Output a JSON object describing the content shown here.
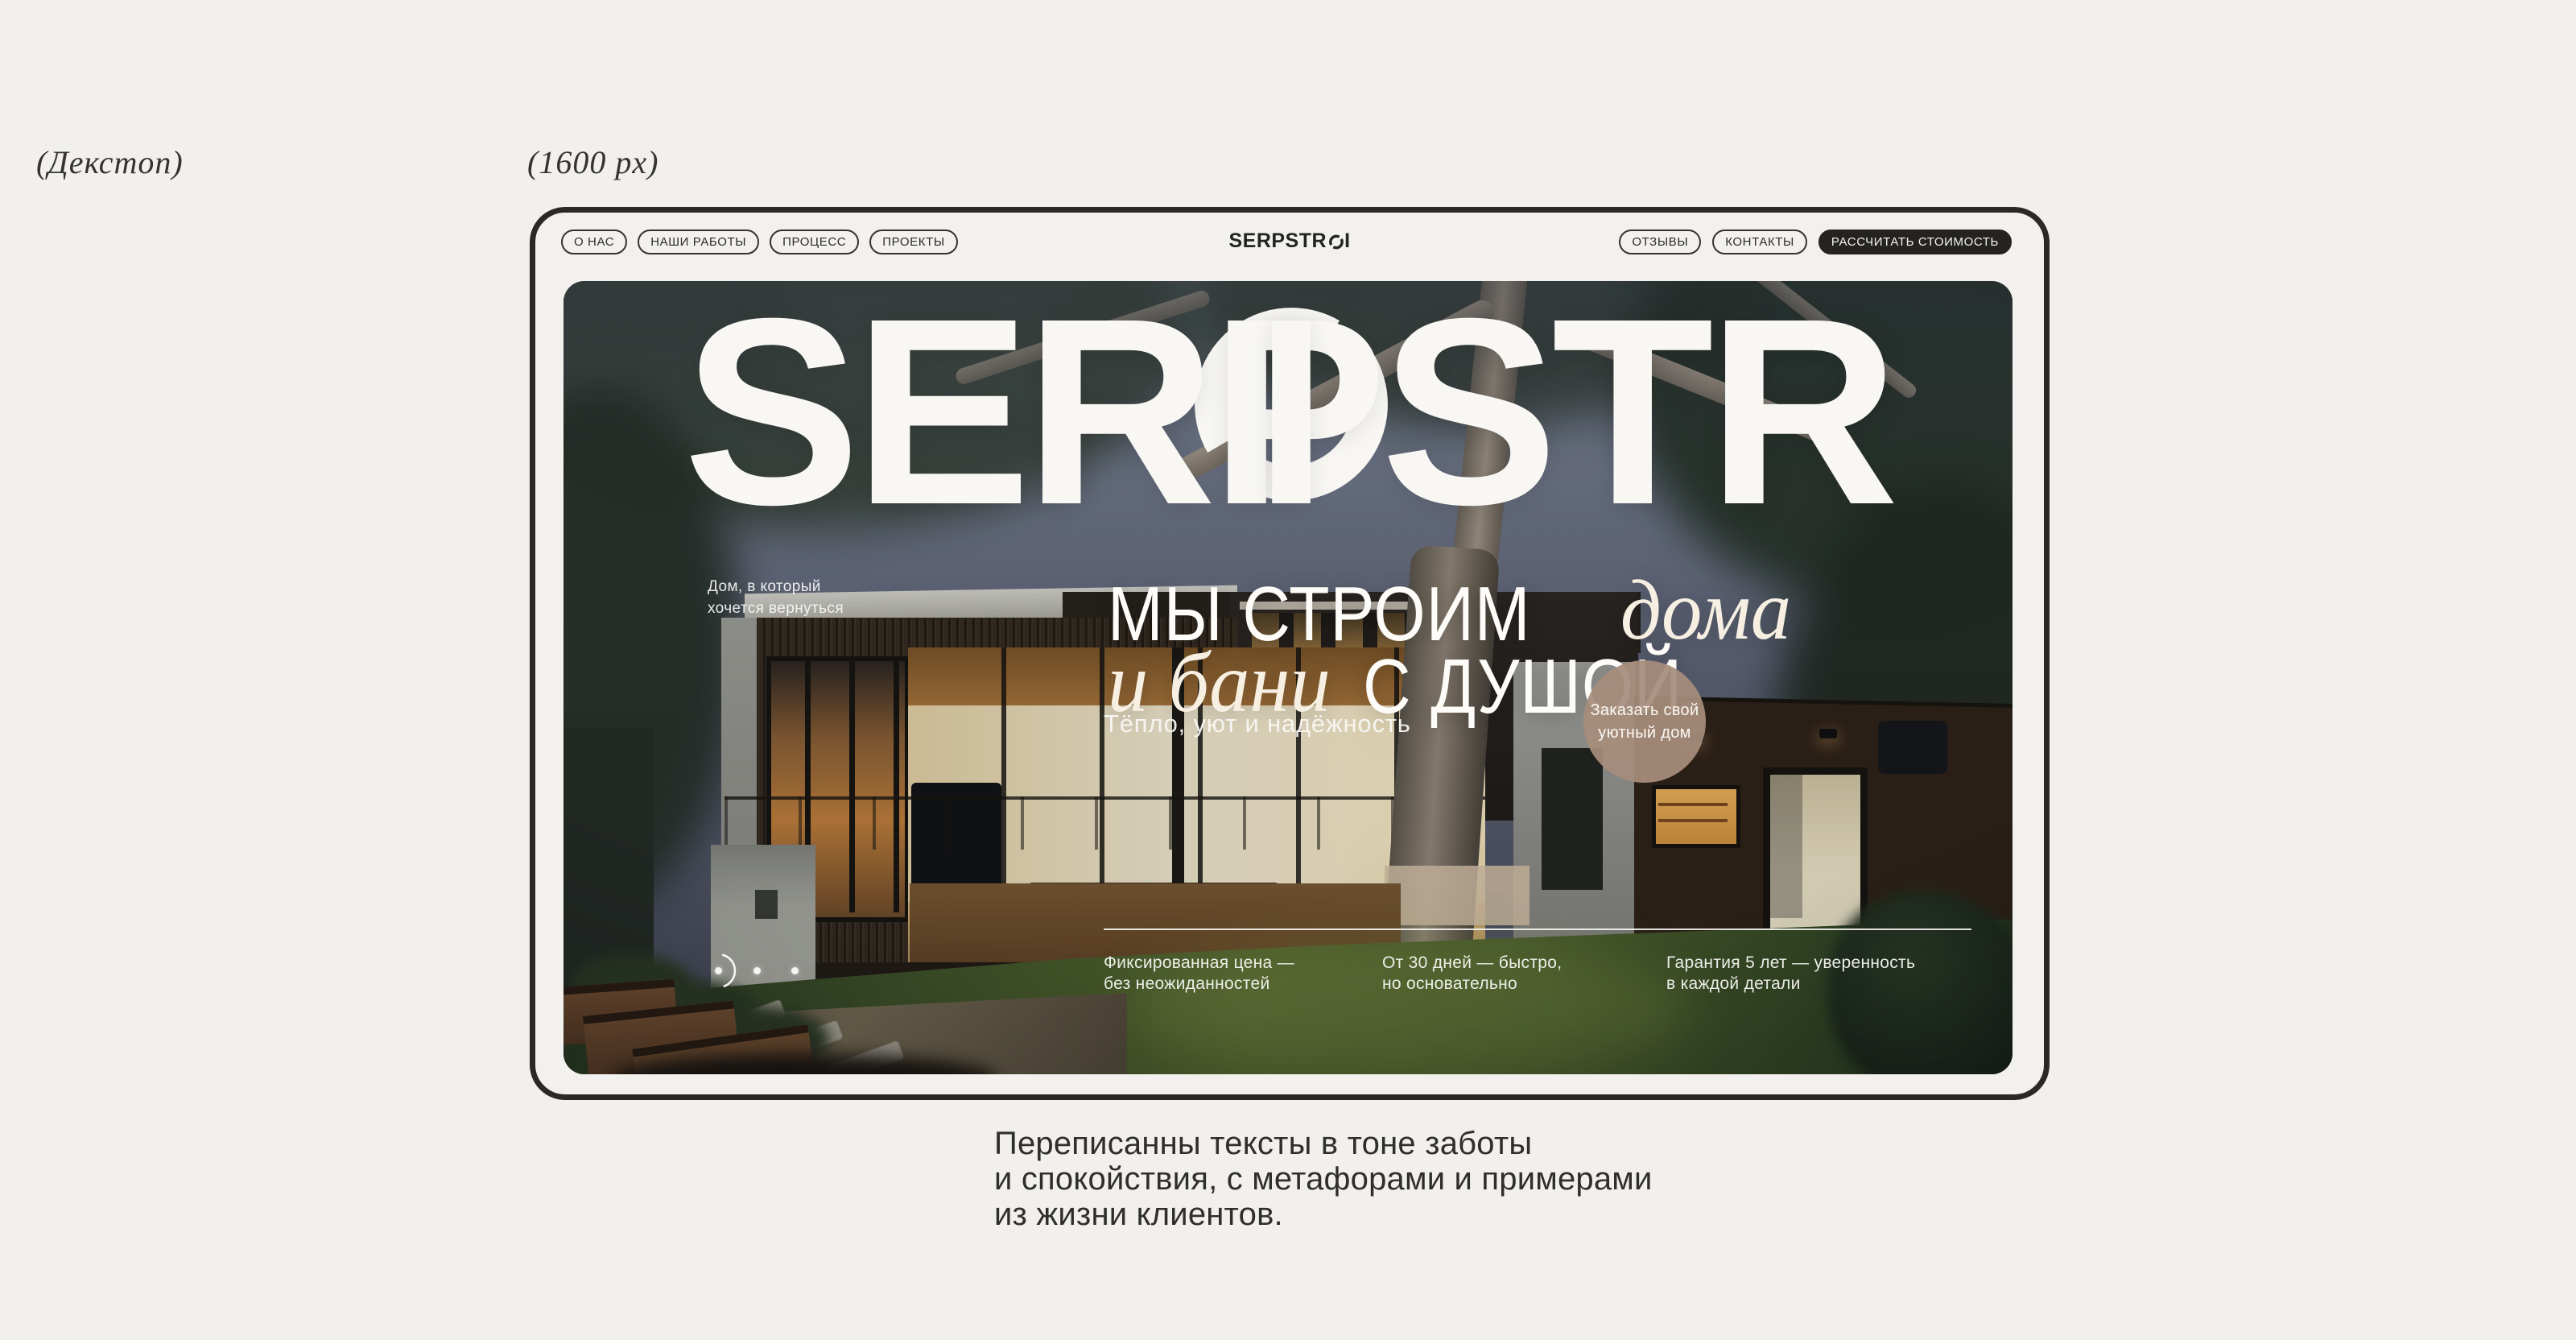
{
  "annotations": {
    "device_label": "(Декстоп)",
    "width_label": "(1600 px)"
  },
  "nav": {
    "left": [
      {
        "label": "О НАС"
      },
      {
        "label": "НАШИ РАБОТЫ"
      },
      {
        "label": "ПРОЦЕСС"
      },
      {
        "label": "ПРОЕКТЫ"
      }
    ],
    "logo": {
      "full": "SERPSTROI",
      "pre": "SERPSTR",
      "post": "I"
    },
    "right": [
      {
        "label": "ОТЗЫВЫ"
      },
      {
        "label": "КОНТАКТЫ"
      }
    ],
    "cta_label": "РАССЧИТАТЬ СТОИМОСТЬ"
  },
  "hero": {
    "title": {
      "full": "SERPSTROI",
      "pre": "SERPSTR",
      "post": "I"
    },
    "tagline": {
      "line1": "Дом, в который",
      "line2": "хочется вернуться"
    },
    "headline": {
      "l1_sans": "МЫ СТРОИМ",
      "l1_serif": "дома",
      "l2_serif": "и бани",
      "l2_sans": "С ДУШОЙ"
    },
    "subline": "Тёпло, уют и надёжность",
    "cta_circle": {
      "line1": "Заказать свой",
      "line2": "уютный дом"
    },
    "features": [
      {
        "line1": "Фиксированная цена —",
        "line2": "без неожиданностей"
      },
      {
        "line1": "От 30 дней — быстро,",
        "line2": "но основательно"
      },
      {
        "line1": "Гарантия 5 лет — уверенность",
        "line2": "в каждой детали"
      }
    ],
    "carousel": {
      "dots_count": 3,
      "active_index": 0
    }
  },
  "caption": {
    "line1": "Переписанны тексты в тоне заботы",
    "line2": "и спокойствия, с метафорами и примерами",
    "line3": "из жизни клиентов."
  },
  "colors": {
    "page_bg": "#F1F0EC",
    "frame_border": "#2A2927",
    "site_bg": "#F2F1ED",
    "cta_pill_bg": "#24231F",
    "circle_cta_bg": "#A78D7C",
    "hero_text": "#F8F7F4",
    "caption_text": "#2F2E2B"
  }
}
